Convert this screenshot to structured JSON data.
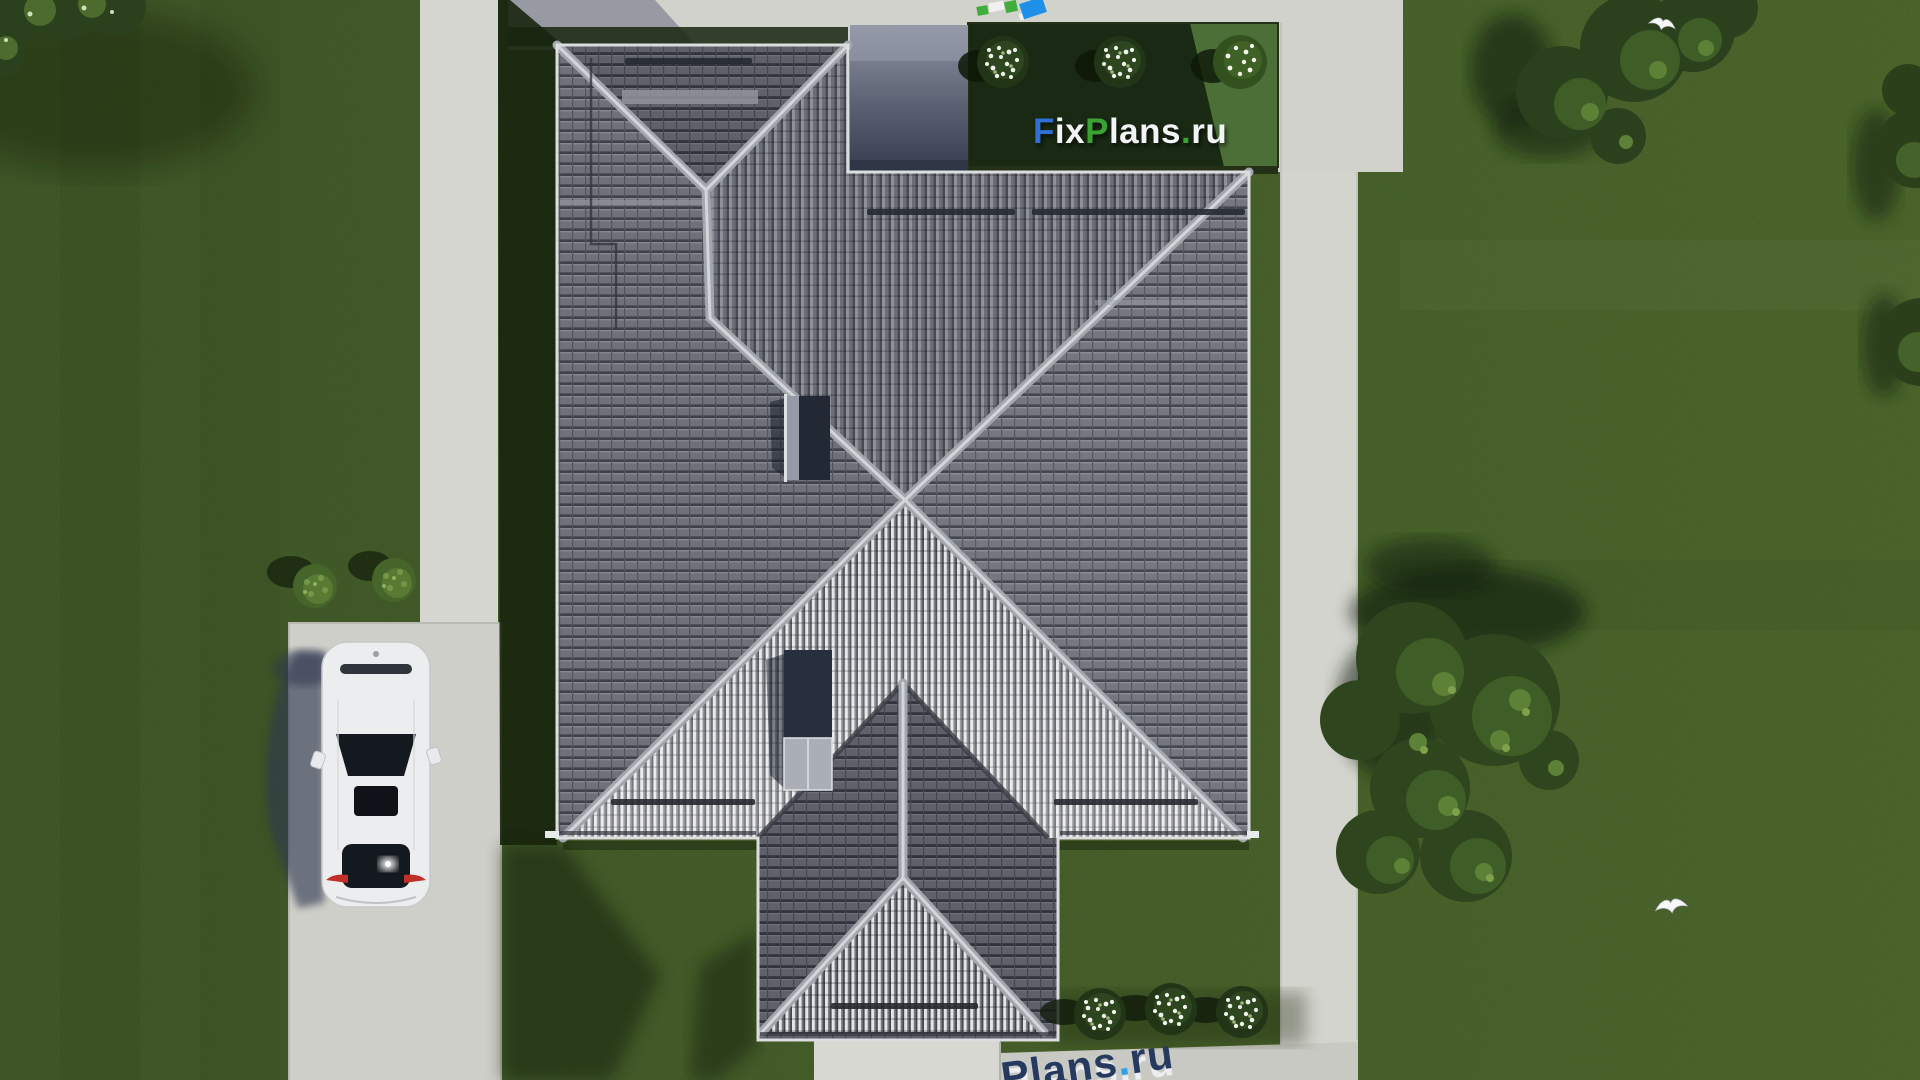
{
  "page": {
    "title": "Aerial top-down render of house roof plan",
    "canvas_width": 1920,
    "canvas_height": 1080
  },
  "watermarks": {
    "main": {
      "text": "FixPlans.ru",
      "f": "F",
      "ix": "ix",
      "p": "P",
      "lans": "lans",
      "dot": ".",
      "ru": "ru",
      "color_f": "#2f6fd6",
      "color_p": "#3aa334",
      "color_dot": "#3aa334",
      "color_letters": "#f3f4f5"
    },
    "bottom": {
      "text": "Plans.ru",
      "plans": "Plans",
      "dot": ".",
      "ru": "ru",
      "color_letters": "#26395f",
      "color_dot": "#2aa1e8"
    }
  },
  "logo_icon": {
    "squares": 5,
    "colors": [
      "#3fae3a",
      "#f0f1ef",
      "#3fae3a",
      "#1e90e8"
    ]
  },
  "scene": {
    "view": "top-down aerial 3d render of a house plot",
    "house": {
      "roof_tile_color": "#65686f",
      "ridge_color": "#d3d5d9",
      "south_slope_highlight": "#e4e5e8",
      "terrace_color": "#5a6172",
      "chimney_count": 2
    },
    "vehicle": {
      "type": "sedan top view",
      "body_color": "#eceeef",
      "parked_on": "left driveway"
    },
    "hardscape": {
      "concrete_color": "#d3d3cd",
      "elements": [
        "left vertical path",
        "left driveway pad",
        "top apron",
        "right vertical path",
        "bottom walkway",
        "south patio"
      ]
    },
    "vegetation": {
      "lawn_color": "#4a632e",
      "flower_bushes_top_bed": 3,
      "flower_bushes_bottom_row": 3,
      "green_bushes_left_lawn": 2,
      "tree_clusters": 4
    },
    "birds": {
      "count": 2,
      "color": "#f6f7f8"
    }
  }
}
